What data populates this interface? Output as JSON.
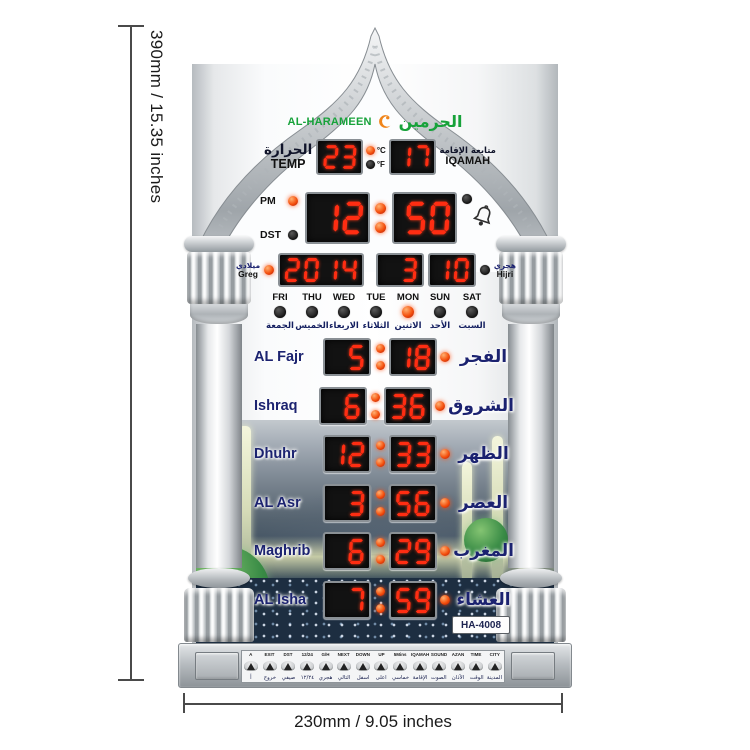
{
  "annotations": {
    "height_label": "390mm / 15.35 inches",
    "width_label": "230mm / 9.05 inches"
  },
  "brand": {
    "latin": "AL-HARAMEEN",
    "arabic": "الحرمين"
  },
  "temp": {
    "label_ar": "الحرارة",
    "label_en": "TEMP",
    "value": "23",
    "unit_c": "°C",
    "unit_f": "°F"
  },
  "iqamah": {
    "label_ar": "متابعة الإقامة",
    "label_en": "IQAMAH",
    "value": "17"
  },
  "clock": {
    "pm_label": "PM",
    "dst_label": "DST",
    "hour": "12",
    "minute": "50"
  },
  "date": {
    "greg_label_ar": "ميلادي",
    "greg_label_en": "Greg",
    "year": "2014",
    "month": "3",
    "day": "10",
    "hijri_label_ar": "هجري",
    "hijri_label_en": "Hijri"
  },
  "days": [
    {
      "en": "FRI",
      "ar": "الجمعة",
      "active": false
    },
    {
      "en": "THU",
      "ar": "الخميس",
      "active": false
    },
    {
      "en": "WED",
      "ar": "الاربعاء",
      "active": false
    },
    {
      "en": "TUE",
      "ar": "الثلاثاء",
      "active": false
    },
    {
      "en": "MON",
      "ar": "الاثنين",
      "active": true
    },
    {
      "en": "SUN",
      "ar": "الأحد",
      "active": false
    },
    {
      "en": "SAT",
      "ar": "السبت",
      "active": false
    }
  ],
  "prayers": [
    {
      "en": "AL Fajr",
      "ar": "الفجر",
      "h": "5",
      "m": "18"
    },
    {
      "en": "Ishraq",
      "ar": "الشروق",
      "h": "6",
      "m": "36"
    },
    {
      "en": "Dhuhr",
      "ar": "الظهر",
      "h": "12",
      "m": "33"
    },
    {
      "en": "AL Asr",
      "ar": "العصر",
      "h": "3",
      "m": "56"
    },
    {
      "en": "Maghrib",
      "ar": "المغرب",
      "h": "6",
      "m": "29"
    },
    {
      "en": "AL Isha",
      "ar": "العشاء",
      "h": "7",
      "m": "59"
    }
  ],
  "model": "HA-4008",
  "buttons": [
    {
      "en": "A",
      "ar": "أ"
    },
    {
      "en": "EXIT",
      "ar": "خروج"
    },
    {
      "en": "DST",
      "ar": "صيفي"
    },
    {
      "en": "12/24",
      "ar": "١٢/٢٤"
    },
    {
      "en": "G/H",
      "ar": "هجري"
    },
    {
      "en": "NEXT",
      "ar": "التالي"
    },
    {
      "en": "DOWN",
      "ar": "اسفل"
    },
    {
      "en": "UP",
      "ar": "اعلى"
    },
    {
      "en": "5Mins",
      "ar": "خماسي"
    },
    {
      "en": "IQAMAH",
      "ar": "الإقامة"
    },
    {
      "en": "SOUND",
      "ar": "الصوت"
    },
    {
      "en": "AZAN",
      "ar": "الآذان"
    },
    {
      "en": "TIME",
      "ar": "الوقت"
    },
    {
      "en": "CITY",
      "ar": "المدينة"
    }
  ],
  "colors": {
    "led_red": "#ff2d12",
    "led_bg": "#121212",
    "brand_green": "#17a23a",
    "brand_orange": "#f08419",
    "label_navy": "#1c2370",
    "silver": "#b8bdc1"
  }
}
